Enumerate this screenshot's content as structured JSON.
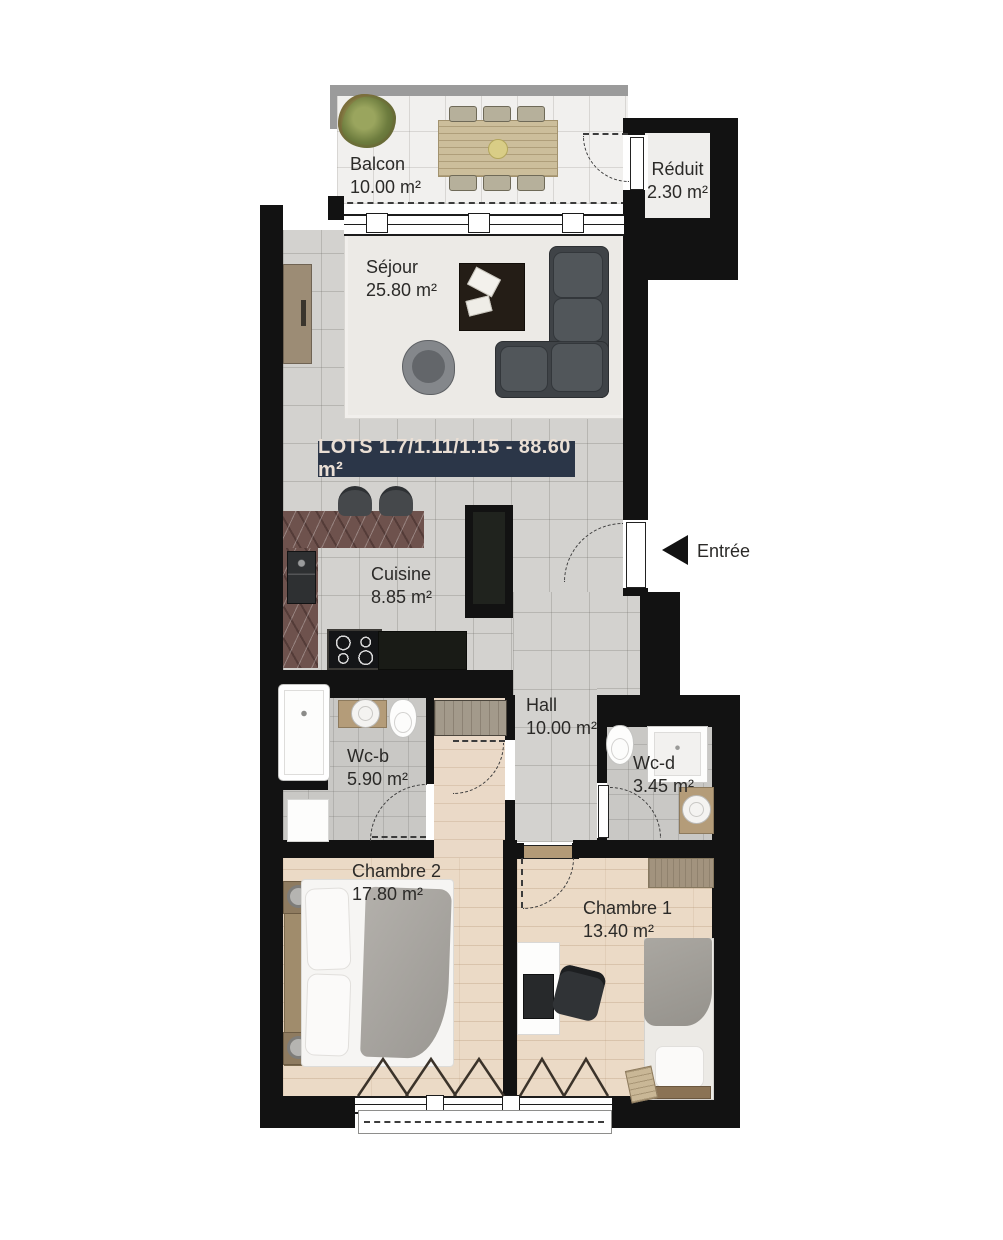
{
  "banner": {
    "text": "LOTS 1.7/1.11/1.15 - 88.60 m²"
  },
  "entrance": {
    "label": "Entrée",
    "arrow_icon": "left-triangle"
  },
  "rooms": {
    "balcon": {
      "name": "Balcon",
      "area": "10.00 m²"
    },
    "reduit": {
      "name": "Réduit",
      "area": "2.30 m²"
    },
    "sejour": {
      "name": "Séjour",
      "area": "25.80 m²"
    },
    "cuisine": {
      "name": "Cuisine",
      "area": "8.85 m²"
    },
    "hall": {
      "name": "Hall",
      "area": "10.00 m²"
    },
    "wcb": {
      "name": "Wc-b",
      "area": "5.90 m²"
    },
    "wcd": {
      "name": "Wc-d",
      "area": "3.45 m²"
    },
    "chambre2": {
      "name": "Chambre 2",
      "area": "17.80 m²"
    },
    "chambre1": {
      "name": "Chambre 1",
      "area": "13.40 m²"
    }
  },
  "colors": {
    "wall": "#121212",
    "banner_bg": "#2b3648",
    "banner_fg": "#eadfd5",
    "tile_floor": "#d3d2cf",
    "wood_floor": "#ebdac6",
    "balcony_floor": "#f1f0ee",
    "sofa": "#3f4347",
    "counter_marble": "#6e524d"
  }
}
